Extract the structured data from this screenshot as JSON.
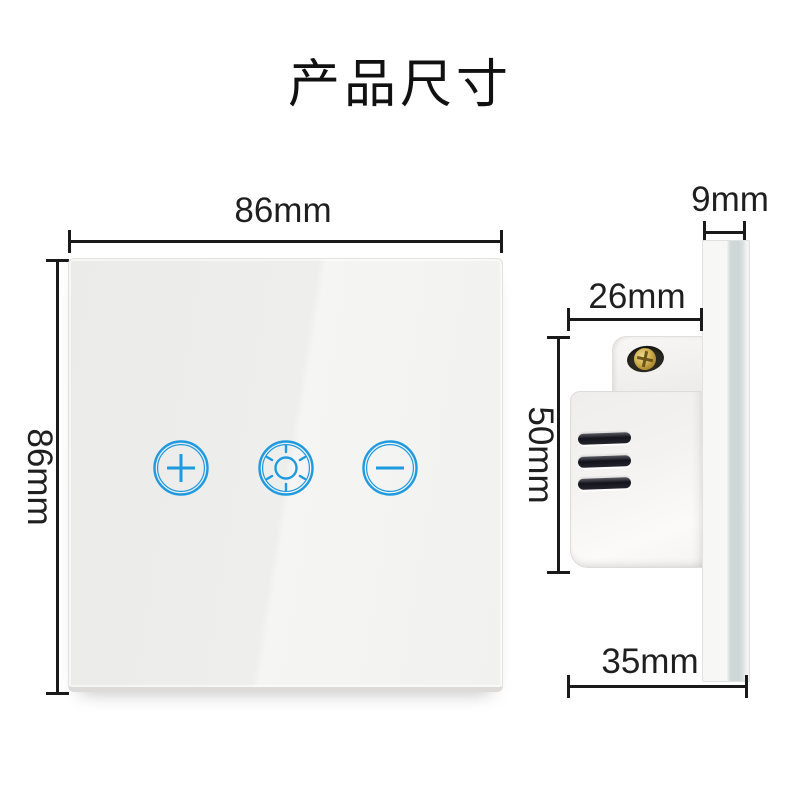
{
  "title": "产品尺寸",
  "front_view": {
    "description": "touch dimmer switch front glass panel",
    "width_label": "86mm",
    "height_label": "86mm",
    "buttons": [
      {
        "id": "dim-increase",
        "icon": "plus-icon"
      },
      {
        "id": "brightness",
        "icon": "sun-icon"
      },
      {
        "id": "dim-decrease",
        "icon": "minus-icon"
      }
    ]
  },
  "side_view": {
    "description": "switch side profile with wall-box mechanism",
    "glass_thickness_label": "9mm",
    "mechanism_depth_label": "26mm",
    "mechanism_height_label": "50mm",
    "total_depth_label": "35mm"
  },
  "colors": {
    "accent_blue": "#1e9ae0",
    "dimension_line": "#1a1a1a",
    "panel_glass": "#efefed",
    "glass_edge_tint": "#ccd7d6"
  }
}
